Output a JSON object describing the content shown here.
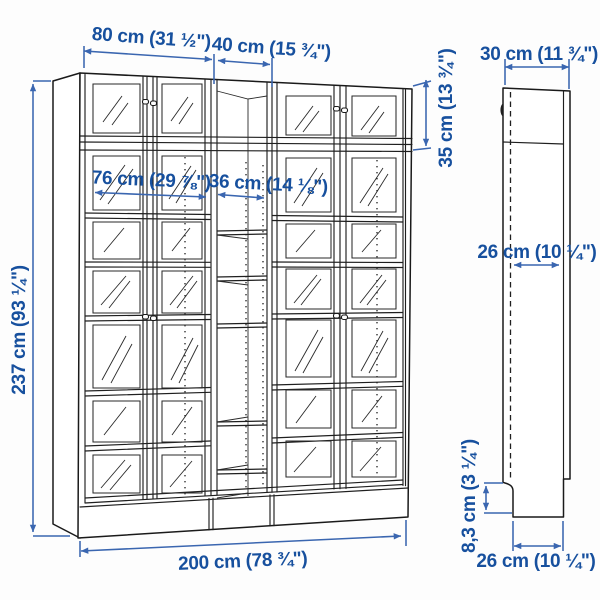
{
  "diagram": {
    "kind": "furniture-dimension-illustration",
    "views": {
      "front": "bookcase combination front view",
      "side": "bookcase side profile view"
    },
    "dimensions": {
      "unit_width_left": "80 cm (31 ½\")",
      "unit_width_middle": "40 cm (15 ¾\")",
      "side_depth": "30 cm (11 ¾\")",
      "extension_height": "35 cm (13 ¾\")",
      "inner_width_left": "76 cm (29 ⅞\")",
      "inner_width_middle": "36 cm (14 ⅛\")",
      "total_height": "237 cm (93 ¼\")",
      "side_inner_depth": "26 cm (10 ¼\")",
      "plinth_height": "8,3 cm (3 ¼\")",
      "side_base_depth": "26 cm (10 ¼\")",
      "total_width": "200 cm (78 ¾\")"
    },
    "colors": {
      "dimension_line": "#3a66b0",
      "dimension_text": "#17509e",
      "outline": "#1f1f1f",
      "background": "#fdfdfd"
    }
  }
}
